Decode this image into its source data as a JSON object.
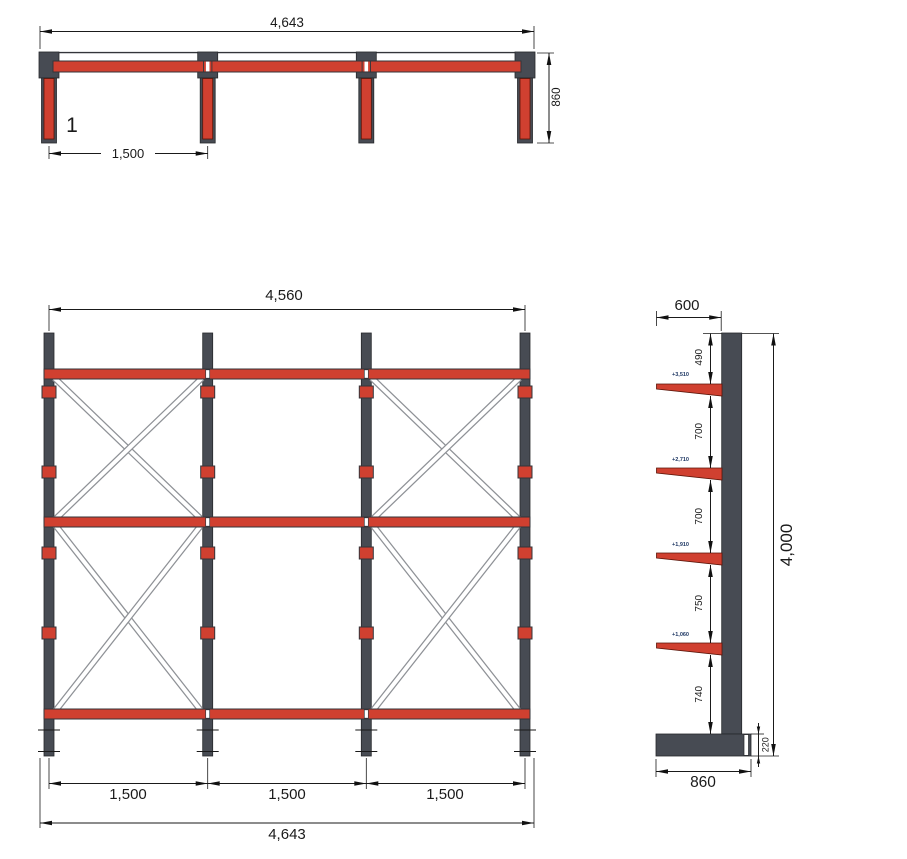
{
  "palette": {
    "beam_red": "#d04030",
    "steel_dark": "#474b53",
    "brace_outline": "#8e9196",
    "dim_line": "#1a1a1a",
    "level_text": "#1f3864"
  },
  "plan_view": {
    "overall_width": "4,643",
    "depth": "860",
    "bay_width": "1,500",
    "item_number": "1"
  },
  "front_view": {
    "frame_width": "4,560",
    "bay_widths": [
      "1,500",
      "1,500",
      "1,500"
    ],
    "overall_width": "4,643"
  },
  "side_view": {
    "arm_length": "600",
    "overall_height": "4,000",
    "base_depth": "860",
    "base_height": "220",
    "spacings": [
      "490",
      "700",
      "700",
      "750",
      "740"
    ],
    "arm_levels": [
      "+3,510",
      "+2,710",
      "+1,910",
      "+1,060"
    ]
  }
}
